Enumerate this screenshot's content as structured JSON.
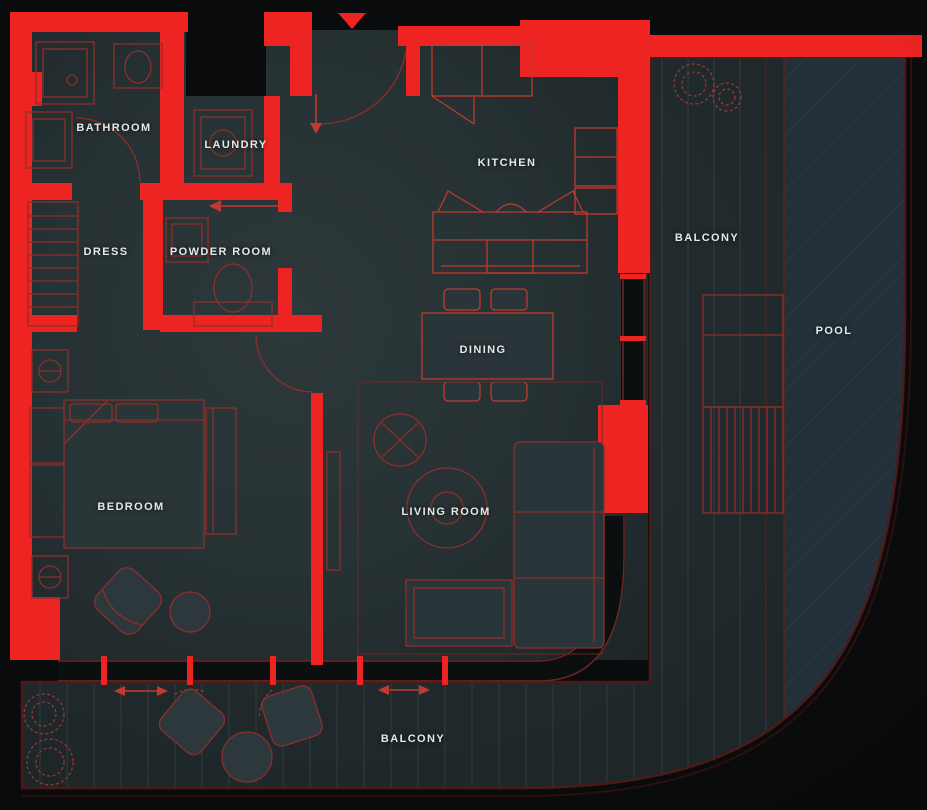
{
  "rooms": [
    {
      "id": "bathroom",
      "name": "BATHROOM"
    },
    {
      "id": "laundry",
      "name": "LAUNDRY"
    },
    {
      "id": "kitchen",
      "name": "KITCHEN"
    },
    {
      "id": "dress",
      "name": "DRESS"
    },
    {
      "id": "powder-room",
      "name": "POWDER ROOM"
    },
    {
      "id": "balcony-right",
      "name": "BALCONY"
    },
    {
      "id": "pool",
      "name": "POOL"
    },
    {
      "id": "dining",
      "name": "DINING"
    },
    {
      "id": "bedroom",
      "name": "BEDROOM"
    },
    {
      "id": "living-room",
      "name": "LIVING ROOM"
    },
    {
      "id": "balcony-bottom",
      "name": "BALCONY"
    }
  ],
  "markers": {
    "entry": "down-triangle",
    "sliding_doors": "double-headed-arrow",
    "swing_doors": "quarter-circle-arc"
  },
  "colors": {
    "bg": "#0a0b0c",
    "wall-red": "#ee2423",
    "floor": "#273336",
    "deck": "#222c2f",
    "pool": "#233039",
    "label": "#e4e8e8",
    "furniture-line": "#8c2f2a",
    "furniture-bright": "#c0392e",
    "board-line": "#46514f",
    "glass-dark": "#0b0f10"
  }
}
